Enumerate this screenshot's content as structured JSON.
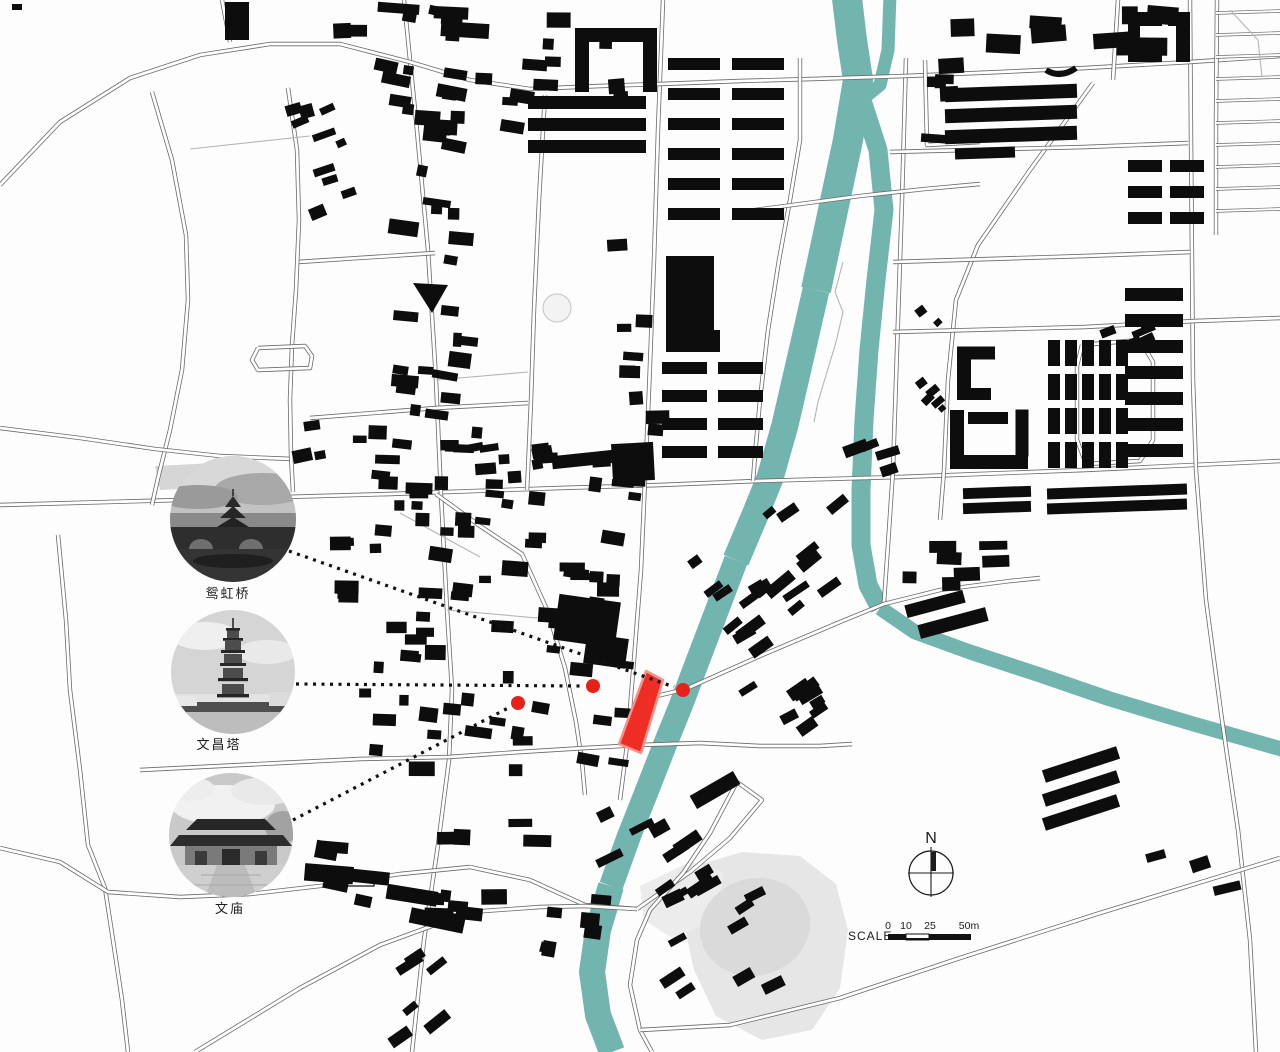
{
  "landmarks": [
    {
      "id": "covered-bridge",
      "label": "鸳虹桥"
    },
    {
      "id": "wenchang-pagoda",
      "label": "文昌塔"
    },
    {
      "id": "confucian-temple",
      "label": "文庙"
    }
  ],
  "north_arrow": {
    "label": "N"
  },
  "scale_bar": {
    "label": "SCALE",
    "ticks": [
      {
        "label": "0"
      },
      {
        "label": "10"
      },
      {
        "label": "25"
      },
      {
        "label": "50m"
      }
    ]
  },
  "colors": {
    "river": "#72b5af",
    "building": "#0d0d0d",
    "site_fill": "#ee2e24",
    "site_edge": "#f6928c",
    "dot": "#e8201a",
    "road_casing": "#6a6a6a",
    "road_fill": "#ffffff",
    "hairline": "#b5b5b5",
    "gray_area": "#e6e6e6",
    "gray_area_dark": "#dadada",
    "leader": "#111111",
    "background": "#fdfdfd"
  }
}
